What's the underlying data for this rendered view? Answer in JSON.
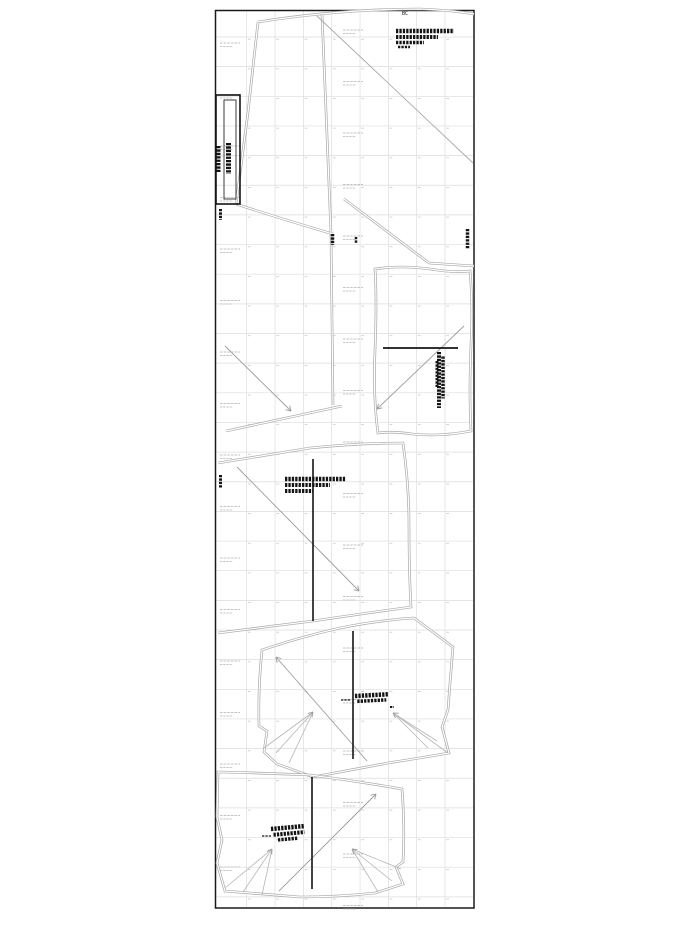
{
  "page": {
    "label": "BC",
    "rect": [
      215.5,
      10.5,
      258.5,
      897.5
    ],
    "label_pos": [
      402,
      12
    ],
    "colors": {
      "border": "#1a1a1a",
      "grid": "#dcdcdc",
      "tick": "#c9c9c9",
      "watermark": "#c3c3ca",
      "outline": "#a8a8a8",
      "arrow": "#9c9c9c",
      "dart": "#b5b5b5",
      "ink": "#141414",
      "paper": "#ffffff"
    }
  },
  "grid": {
    "x0": 246.7,
    "dx": 28.33,
    "nx": 8,
    "y0": 37.0,
    "dy": 29.65,
    "ny": 30,
    "tick_len": 2.8
  },
  "watermark": {
    "columns": [
      {
        "x": 220,
        "y0": 43,
        "rows": 17
      },
      {
        "x": 343,
        "y0": 30,
        "rows": 18
      }
    ],
    "step": 51.5,
    "line1_w": 20,
    "line2_w": 13,
    "gap": 3.5
  },
  "outlines": [
    {
      "name": "top-panel-upper-edge",
      "d": "M258,22 Q340,9 420,9 Q450,10 474,14"
    },
    {
      "name": "top-panel-left-edge",
      "d": "M258,22 L248,112 L239,182 L236,204"
    },
    {
      "name": "top-panel-bottom-edge",
      "d": "M236,204 Q282,219 333,234"
    },
    {
      "name": "top-panel-right-edge",
      "d": "M322,14 Q327,130 331,233"
    },
    {
      "name": "wedge-right-edge",
      "d": "M331,234 L333,405"
    },
    {
      "name": "wedge-bottom-edge",
      "d": "M226,431 L342,406"
    },
    {
      "name": "sliver-edge",
      "d": "M344,199 L429,263 L474,266"
    },
    {
      "name": "piece2-outline",
      "d": "M375,269 Q400,265 430,269 Q455,273 470,271 Q473,305 471,345 Q469,392 471,431 Q440,437 412,434 Q392,431 378,433 Q373,398 375,350 Q377,300 375,269 Z"
    },
    {
      "name": "piece3-outline",
      "d": "M218,463 L310,448 Q360,443 403,443 Q409,485 409,525 Q409,572 411,607 Q360,614 313,621 L218,633"
    },
    {
      "name": "piece4-outline",
      "d": "M262,650 Q300,637 340,628 Q380,620 414,618 L453,647 Q450,682 448,710 L442,727 L449,753 Q420,758 388,763 Q350,770 313,777 L277,764 L264,752 L267,731 L259,726 Q258,688 262,650 Z"
    },
    {
      "name": "piece5-outline",
      "d": "M218,772 Q265,773 310,775 Q357,781 402,789 Q405,828 403,862 L396,867 L403,884 L375,893 Q337,897 300,897 Q262,894 225,891 L217,863 L222,840 L217,817 Z"
    }
  ],
  "single_lines": [
    {
      "name": "bias-line",
      "x1": 317,
      "y1": 16,
      "x2": 473,
      "y2": 163
    }
  ],
  "strap_piece": {
    "outer": [
      216,
      95,
      24,
      109
    ],
    "inner": [
      224,
      100,
      12,
      99
    ]
  },
  "heavy_lines": [
    {
      "name": "piece2-fold-line",
      "x1": 383,
      "y1": 348,
      "x2": 458,
      "y2": 348,
      "w": 1.8
    },
    {
      "name": "piece3-grain-line",
      "x1": 313,
      "y1": 459,
      "x2": 313,
      "y2": 621,
      "w": 1.6
    },
    {
      "name": "piece4-grain-line",
      "x1": 353,
      "y1": 631,
      "x2": 353,
      "y2": 759,
      "w": 1.6
    },
    {
      "name": "piece5-grain-line",
      "x1": 312,
      "y1": 777,
      "x2": 312,
      "y2": 889,
      "w": 1.6
    }
  ],
  "arrows": [
    {
      "name": "wedge-grain-arrow",
      "x1": 225,
      "y1": 346,
      "x2": 291,
      "y2": 411
    },
    {
      "name": "piece2-grain-arrow",
      "x1": 464,
      "y1": 326,
      "x2": 377,
      "y2": 409
    },
    {
      "name": "piece3-grain-arrow",
      "x1": 237,
      "y1": 467,
      "x2": 359,
      "y2": 591
    },
    {
      "name": "piece4-grain-arrow",
      "x1": 367,
      "y1": 761,
      "x2": 276,
      "y2": 657
    },
    {
      "name": "piece5-grain-arrow",
      "x1": 279,
      "y1": 891,
      "x2": 376,
      "y2": 794
    }
  ],
  "darts": [
    {
      "name": "piece4-left-dart",
      "apex": [
        313,
        712
      ],
      "ends": [
        [
          264,
          748
        ],
        [
          276,
          753
        ],
        [
          289,
          763
        ]
      ]
    },
    {
      "name": "piece4-right-dart",
      "apex": [
        393,
        713
      ],
      "ends": [
        [
          428,
          748
        ],
        [
          437,
          741
        ],
        [
          448,
          753
        ]
      ]
    },
    {
      "name": "piece5-left-dart",
      "apex": [
        272,
        849
      ],
      "ends": [
        [
          225,
          888
        ],
        [
          243,
          892
        ],
        [
          262,
          895
        ]
      ]
    },
    {
      "name": "piece5-right-dart",
      "apex": [
        352,
        849
      ],
      "ends": [
        [
          378,
          892
        ],
        [
          392,
          881
        ],
        [
          401,
          869
        ]
      ]
    }
  ],
  "annotations": [
    {
      "name": "top-right-piece-info",
      "x": 396,
      "y": 31,
      "rot": 0,
      "lines": [
        [
          0,
          0,
          58,
          4.5
        ],
        [
          0,
          6,
          42,
          4
        ],
        [
          0,
          11.5,
          28,
          3.5
        ],
        [
          2,
          16,
          12,
          2.5
        ]
      ]
    },
    {
      "name": "strap-label-col1",
      "x": 218.5,
      "y": 146,
      "rot": 90,
      "lines": [
        [
          0,
          0,
          26,
          4
        ]
      ]
    },
    {
      "name": "strap-label-col2",
      "x": 228.5,
      "y": 143,
      "rot": 90,
      "lines": [
        [
          0,
          0,
          31,
          5
        ]
      ]
    },
    {
      "name": "mark-below-strap",
      "x": 220.5,
      "y": 209,
      "rot": 90,
      "lines": [
        [
          0,
          0,
          11,
          3
        ]
      ]
    },
    {
      "name": "mark-panel-bottom",
      "x": 332.5,
      "y": 234,
      "rot": 90,
      "lines": [
        [
          0,
          0,
          11,
          3.5
        ]
      ]
    },
    {
      "name": "mark-panel-bottom-2",
      "x": 356,
      "y": 237,
      "rot": 90,
      "lines": [
        [
          0,
          0,
          6,
          2.5
        ]
      ]
    },
    {
      "name": "mark-right-edge",
      "x": 467.5,
      "y": 229,
      "rot": 90,
      "lines": [
        [
          0,
          0,
          20,
          3.5
        ]
      ]
    },
    {
      "name": "piece2-info-vertical",
      "x": 439,
      "y": 352,
      "rot": 90,
      "lines": [
        [
          0,
          0,
          56,
          4
        ],
        [
          4.5,
          -4,
          42,
          3.5
        ],
        [
          9,
          2,
          26,
          3
        ]
      ]
    },
    {
      "name": "piece3-info",
      "x": 285,
      "y": 479,
      "rot": 0,
      "lines": [
        [
          0,
          0,
          61,
          4.5
        ],
        [
          0,
          6,
          45,
          4
        ],
        [
          0,
          12,
          28,
          4
        ]
      ]
    },
    {
      "name": "piece3-left-mark",
      "x": 220.5,
      "y": 475,
      "rot": 90,
      "lines": [
        [
          0,
          0,
          13,
          3
        ]
      ]
    },
    {
      "name": "piece4-dash",
      "x": 341,
      "y": 700,
      "rot": 0,
      "lines": [
        [
          0,
          0,
          10,
          1.2
        ]
      ]
    },
    {
      "name": "piece4-info",
      "x": 355,
      "y": 696,
      "rot": -3,
      "lines": [
        [
          0,
          0,
          34,
          4.5
        ],
        [
          2,
          5.5,
          29,
          3.5
        ]
      ]
    },
    {
      "name": "piece4-tiny-mark",
      "x": 390,
      "y": 707,
      "rot": 0,
      "lines": [
        [
          0,
          0,
          4,
          2
        ]
      ]
    },
    {
      "name": "piece5-dash",
      "x": 262,
      "y": 836,
      "rot": 0,
      "lines": [
        [
          0,
          0,
          9,
          1.2
        ]
      ]
    },
    {
      "name": "piece5-info",
      "x": 271,
      "y": 829,
      "rot": -5,
      "lines": [
        [
          0,
          0,
          33,
          4.5
        ],
        [
          2,
          6,
          31,
          4
        ],
        [
          6,
          11.5,
          20,
          3.5
        ]
      ]
    }
  ]
}
